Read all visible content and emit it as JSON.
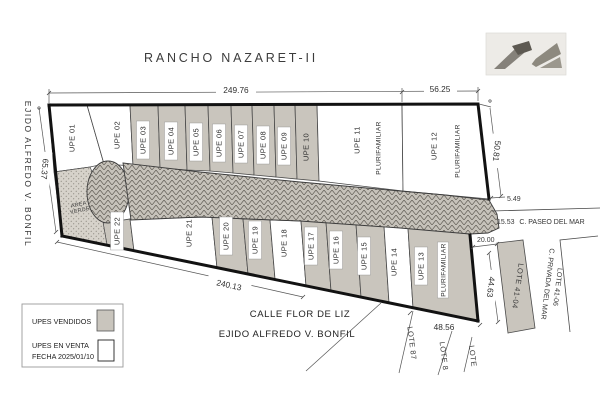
{
  "title": "RANCHO NAZARET-II",
  "streets": {
    "left_vertical": "EJIDO ALFREDO V. BONFIL",
    "bottom_line1": "CALLE FLOR DE LIZ",
    "bottom_line2": "EJIDO ALFREDO V. BONFIL",
    "paseo_del_mar": "C. PASEO DEL MAR",
    "privada_del_mar": "C. PRIVADA DEL MAR"
  },
  "dimensions": {
    "top_main": "249.76",
    "top_right": "56.25",
    "left_edge": "65.37",
    "right_edge": "50.81",
    "bottom_main": "240.13",
    "jog": "5.49",
    "paseo_offset": "15.53",
    "lote_width": "20.00",
    "lote_depth": "44.63",
    "bottom_right": "48.56"
  },
  "area_verde": {
    "line1": "AREA",
    "line2": "VERDE"
  },
  "plurifamiliar_label": "PLURIFAMILIAR",
  "lots": [
    {
      "label": "UPE 01",
      "status": "en venta"
    },
    {
      "label": "UPE 02",
      "status": "en venta"
    },
    {
      "label": "UPE 03",
      "status": "vendido"
    },
    {
      "label": "UPE 04",
      "status": "vendido"
    },
    {
      "label": "UPE 05",
      "status": "vendido"
    },
    {
      "label": "UPE 06",
      "status": "vendido"
    },
    {
      "label": "UPE 07",
      "status": "vendido"
    },
    {
      "label": "UPE 08",
      "status": "vendido"
    },
    {
      "label": "UPE 09",
      "status": "vendido"
    },
    {
      "label": "UPE 10",
      "status": "vendido"
    },
    {
      "label": "UPE 11",
      "status": "en venta"
    },
    {
      "label": "UPE 12",
      "status": "en venta"
    },
    {
      "label": "UPE 13",
      "status": "vendido"
    },
    {
      "label": "UPE 14",
      "status": "en venta"
    },
    {
      "label": "UPE 15",
      "status": "vendido"
    },
    {
      "label": "UPE 16",
      "status": "vendido"
    },
    {
      "label": "UPE 17",
      "status": "vendido"
    },
    {
      "label": "UPE 18",
      "status": "en venta"
    },
    {
      "label": "UPE 19",
      "status": "vendido"
    },
    {
      "label": "UPE 20",
      "status": "vendido"
    },
    {
      "label": "UPE 21",
      "status": "en venta"
    },
    {
      "label": "UPE 22",
      "status": "vendido"
    }
  ],
  "neighbor_lots": {
    "lote_41_04": "LOTE 41-04",
    "lote_41_06": "LOTE 41-06",
    "lote_87": "LOTE 87",
    "lote_8": "LOTE 8",
    "lote": "LOTE"
  },
  "legend": {
    "sold": "UPES VENDIDOS",
    "for_sale": "UPES EN VENTA",
    "date_label": "FECHA",
    "date_value": "2025/01/10"
  },
  "colors": {
    "sold_fill": "#c9c5bd",
    "available_fill": "#ffffff",
    "road_fill": "#c6c2ba",
    "outline": "#121212"
  }
}
